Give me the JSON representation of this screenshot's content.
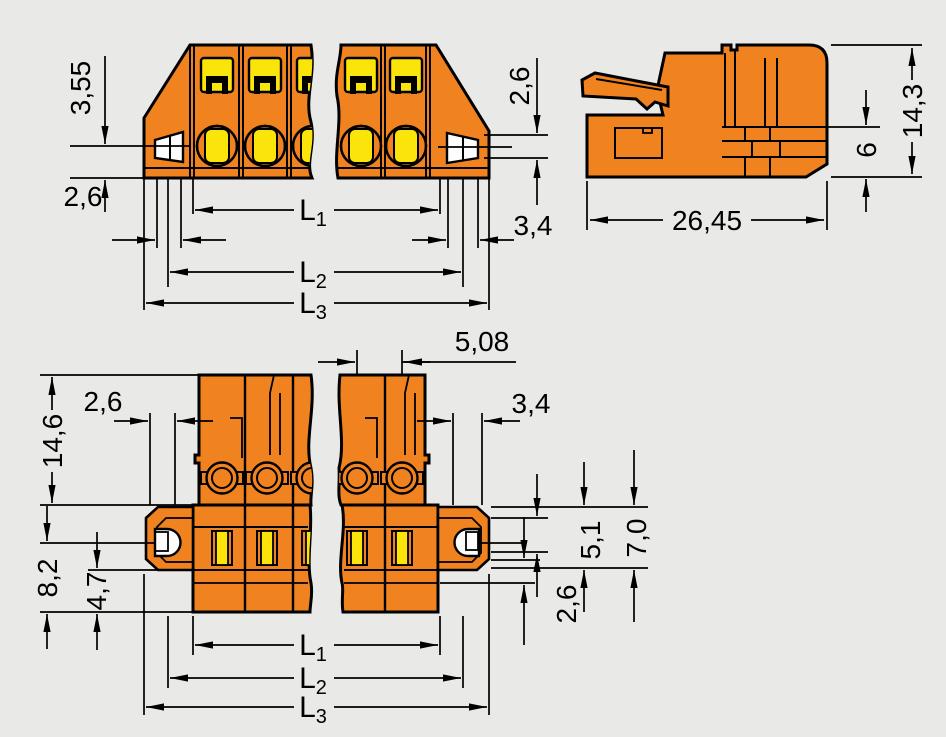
{
  "drawing": {
    "type": "technical dimensional drawing",
    "subject": "pluggable female terminal-block connector with mounting flanges",
    "colors": {
      "housing_orange": "#F0831F",
      "detail_yellow": "#FBE409",
      "line_black": "#000000",
      "background_gray": "#E9E9E8",
      "hole_white": "#FDFDFD"
    },
    "front": {
      "d355": "3,55",
      "d26_left": "2,6",
      "d26_right": "2,6",
      "d34": "3,4"
    },
    "side": {
      "d143": "14,3",
      "d6": "6",
      "d2645": "26,45"
    },
    "bottom": {
      "d508": "5,08",
      "d26_top": "2,6",
      "d34": "3,4",
      "d146": "14,6",
      "d82": "8,2",
      "d47": "4,7",
      "d26_low": "2,6",
      "d51": "5,1",
      "d70": "7,0"
    },
    "lengths": {
      "L": "L",
      "s1": "1",
      "s2": "2",
      "s3": "3"
    }
  }
}
